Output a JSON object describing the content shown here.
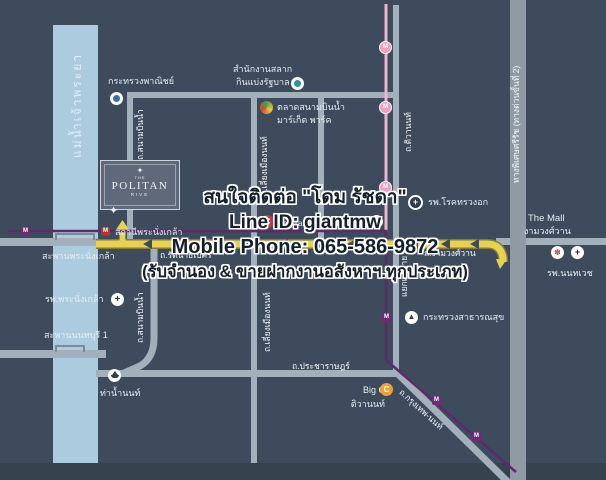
{
  "colors": {
    "background": "#3d4b5d",
    "river": "#accbdf",
    "road": "#a2b0bc",
    "expressway": "#8f9aa5",
    "highway_yellow": "#e6d150",
    "mrt_purple": "#5f2a68",
    "mrt_pink": "#efb4cc"
  },
  "river": {
    "label": "แม่น้ำเจ้าพระยา"
  },
  "logo": {
    "pre": "THE",
    "name": "POLITAN",
    "sub": "RIVE"
  },
  "contact": {
    "line1": "สนใจติดต่อ \"โดม รัชดา\"",
    "line2": "Line ID: giantmw",
    "line3": "Mobile Phone: 065-586-9872",
    "line4": "(รับจำนอง & ขายฝากงานอสังหาฯ.ทุกประเภท)"
  },
  "roads": {
    "sanambinnam": "ถ.สนามบินน้ำ",
    "liang_mueang": "ถ.เลี่ยงเมืองนนท์",
    "tiwanon": "ถ.ติวานนท์",
    "khae_rai": "แยกแคราย",
    "rattanathibet": "ถ.รัตนาธิเบศร์",
    "ngamwongwan": "ถ.งามวงศ์วาน",
    "pracharat": "ถ.ประชาราษฎร์",
    "bangkok_nonthaburi": "ถ.กรุงเทพ-นนท์",
    "expressway": "ทางพิเศษศรีรัช (ทางด่วนขั้นที่ 2)"
  },
  "places": {
    "ministry_commerce": "กระทรวงพาณิชย์",
    "lottery_office_1": "สำนักงานสลาก",
    "lottery_office_2": "กินแบ่งรัฐบาล",
    "market_1": "ตลาดสนามบินน้ำ",
    "market_2": "มาร์เก็ต พาร์ค",
    "lotus": "Lotus",
    "central": "Central รัตนาธิเบศร์",
    "chest_hospital": "รพ.โรคทรวงอก",
    "the_mall_1": "The Mall",
    "the_mall_2": "งามวงศ์วาน",
    "nonthavej_hospital": "รพ.นนทเวช",
    "ministry_health": "กระทรวงสาธารณสุข",
    "big_c_1": "Big C",
    "big_c_2": "ติวานนท์",
    "nont_pier": "ท่าน้ำนนท์",
    "pranangklao_station": "สถานีพระนั่งเกล้า",
    "pranangklao_bridge": "สะพานพระนั่งเกล้า",
    "pranangklao_hospital": "รพ.พระนั่งเกล้า",
    "nonthaburi_bridge": "สะพานนนทบุรี 1"
  },
  "icons": {
    "metro": "M",
    "compass": "✦",
    "logo_mark": "✦",
    "cross": "+",
    "central_c": "C",
    "bigc_c": "C",
    "flower": "✽",
    "temple": "▲"
  }
}
